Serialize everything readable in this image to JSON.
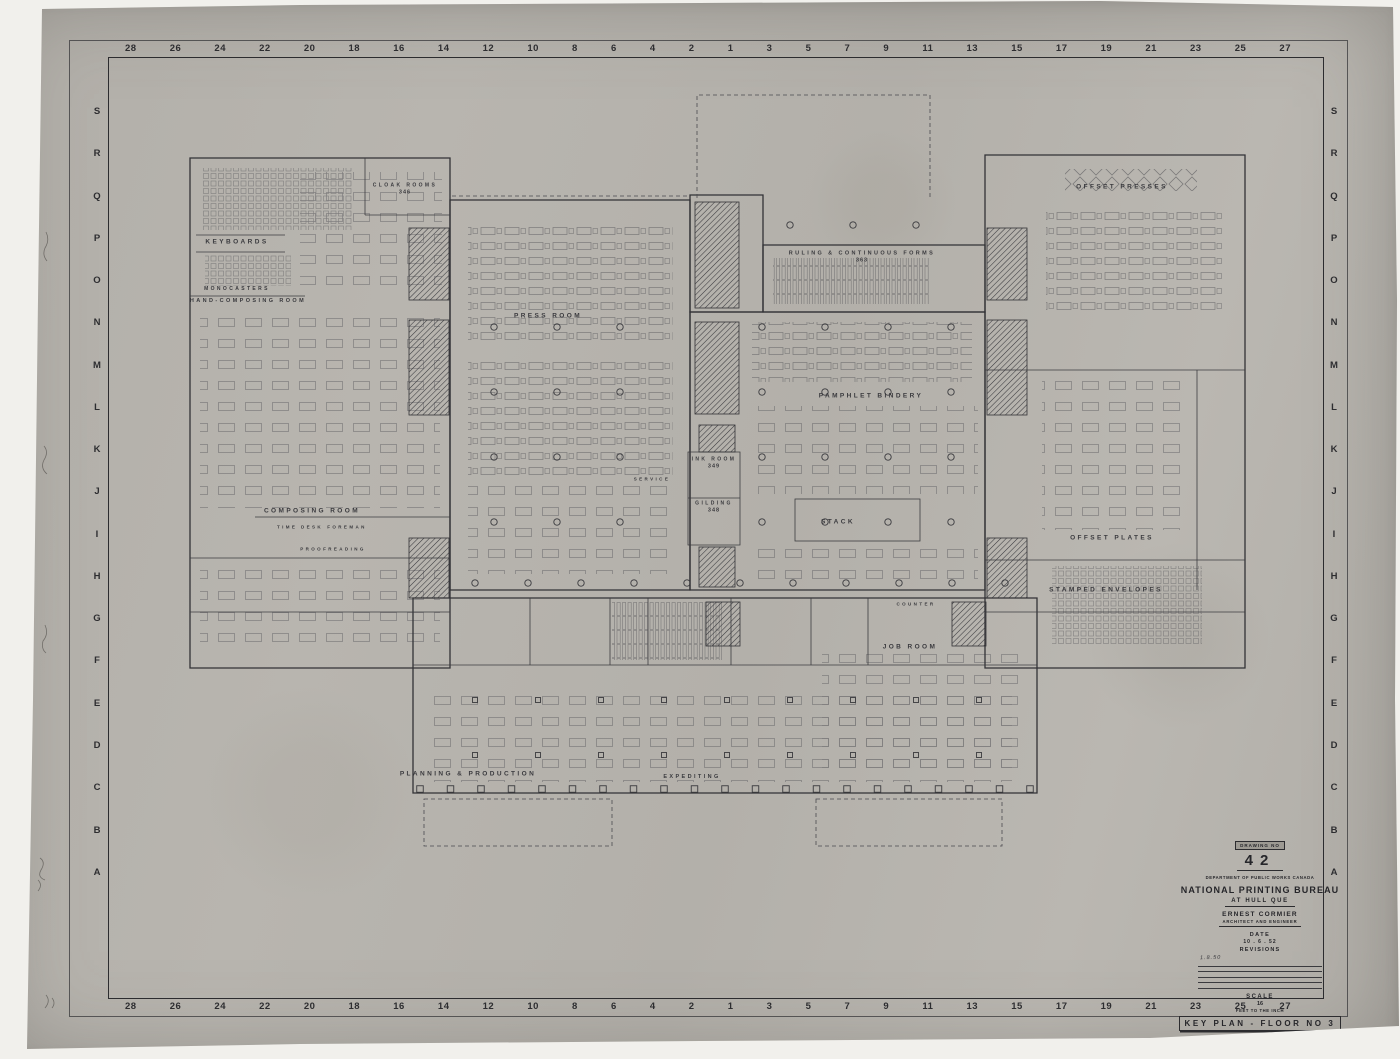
{
  "sheet": {
    "background_color": "#f1f0ec",
    "paper_color": "#b6b3ad",
    "ink_color": "#333336"
  },
  "ruler": {
    "top_numbers": [
      "28",
      "26",
      "24",
      "22",
      "20",
      "18",
      "16",
      "14",
      "12",
      "10",
      "8",
      "6",
      "4",
      "2",
      "1",
      "3",
      "5",
      "7",
      "9",
      "11",
      "13",
      "15",
      "17",
      "19",
      "21",
      "23",
      "25",
      "27"
    ],
    "bottom_numbers": [
      "28",
      "26",
      "24",
      "22",
      "20",
      "18",
      "16",
      "14",
      "12",
      "10",
      "8",
      "6",
      "4",
      "2",
      "1",
      "3",
      "5",
      "7",
      "9",
      "11",
      "13",
      "15",
      "17",
      "19",
      "21",
      "23",
      "25",
      "27"
    ],
    "left_letters": [
      "S",
      "R",
      "Q",
      "P",
      "O",
      "N",
      "M",
      "L",
      "K",
      "J",
      "I",
      "H",
      "G",
      "F",
      "E",
      "D",
      "C",
      "B",
      "A"
    ],
    "right_letters": [
      "S",
      "R",
      "Q",
      "P",
      "O",
      "N",
      "M",
      "L",
      "K",
      "J",
      "I",
      "H",
      "G",
      "F",
      "E",
      "D",
      "C",
      "B",
      "A"
    ]
  },
  "plan": {
    "rooms": [
      {
        "label": "KEYBOARDS",
        "x": 237,
        "y": 242
      },
      {
        "label": "MONOCASTERS",
        "x": 237,
        "y": 289,
        "size": 5
      },
      {
        "label": "HAND-COMPOSING ROOM",
        "x": 248,
        "y": 301,
        "size": 5.5
      },
      {
        "label": "CLOAK ROOMS",
        "number": "346",
        "x": 405,
        "y": 189,
        "size": 5
      },
      {
        "label": "PRESS ROOM",
        "x": 548,
        "y": 316
      },
      {
        "label": "RULING & CONTINUOUS FORMS",
        "number": "363",
        "x": 862,
        "y": 257,
        "size": 5.5
      },
      {
        "label": "OFFSET PRESSES",
        "x": 1122,
        "y": 187
      },
      {
        "label": "PAMPHLET BINDERY",
        "x": 871,
        "y": 396
      },
      {
        "label": "COMPOSING ROOM",
        "x": 312,
        "y": 511
      },
      {
        "label": "TIME DESK",
        "x": 300,
        "y": 527,
        "size": 4.5
      },
      {
        "label": "FOREMAN",
        "x": 347,
        "y": 527,
        "size": 4.5
      },
      {
        "label": "PROOFREADING",
        "x": 333,
        "y": 549,
        "size": 4.5
      },
      {
        "label": "INK ROOM",
        "number": "349",
        "x": 714,
        "y": 463,
        "size": 5
      },
      {
        "label": "GILDING",
        "number": "348",
        "x": 714,
        "y": 507,
        "size": 5
      },
      {
        "label": "SERVICE",
        "x": 652,
        "y": 479,
        "size": 4.5
      },
      {
        "label": "STACK",
        "x": 838,
        "y": 522
      },
      {
        "label": "OFFSET PLATES",
        "x": 1112,
        "y": 538
      },
      {
        "label": "STAMPED ENVELOPES",
        "x": 1106,
        "y": 590
      },
      {
        "label": "JOB ROOM",
        "x": 910,
        "y": 647
      },
      {
        "label": "COUNTER",
        "x": 916,
        "y": 604,
        "size": 4.5
      },
      {
        "label": "PLANNING & PRODUCTION",
        "x": 468,
        "y": 774
      },
      {
        "label": "EXPEDITING",
        "x": 692,
        "y": 777,
        "size": 5.5
      }
    ]
  },
  "title_block": {
    "drawing_no_label": "DRAWING NO",
    "drawing_no": "42",
    "department": "DEPARTMENT OF PUBLIC WORKS CANADA",
    "project_title": "NATIONAL PRINTING BUREAU",
    "location": "AT HULL QUE",
    "architect": "ERNEST CORMIER",
    "architect_role": "ARCHITECT AND ENGINEER",
    "date_label": "DATE",
    "date_value": "10 . 6 . 52",
    "revisions_label": "REVISIONS",
    "revision_note": "1.8.50",
    "scale_label": "SCALE",
    "scale_value": "16",
    "scale_sub": "FEET TO THE INCH",
    "sheet_title": "KEY PLAN - FLOOR NO 3"
  }
}
